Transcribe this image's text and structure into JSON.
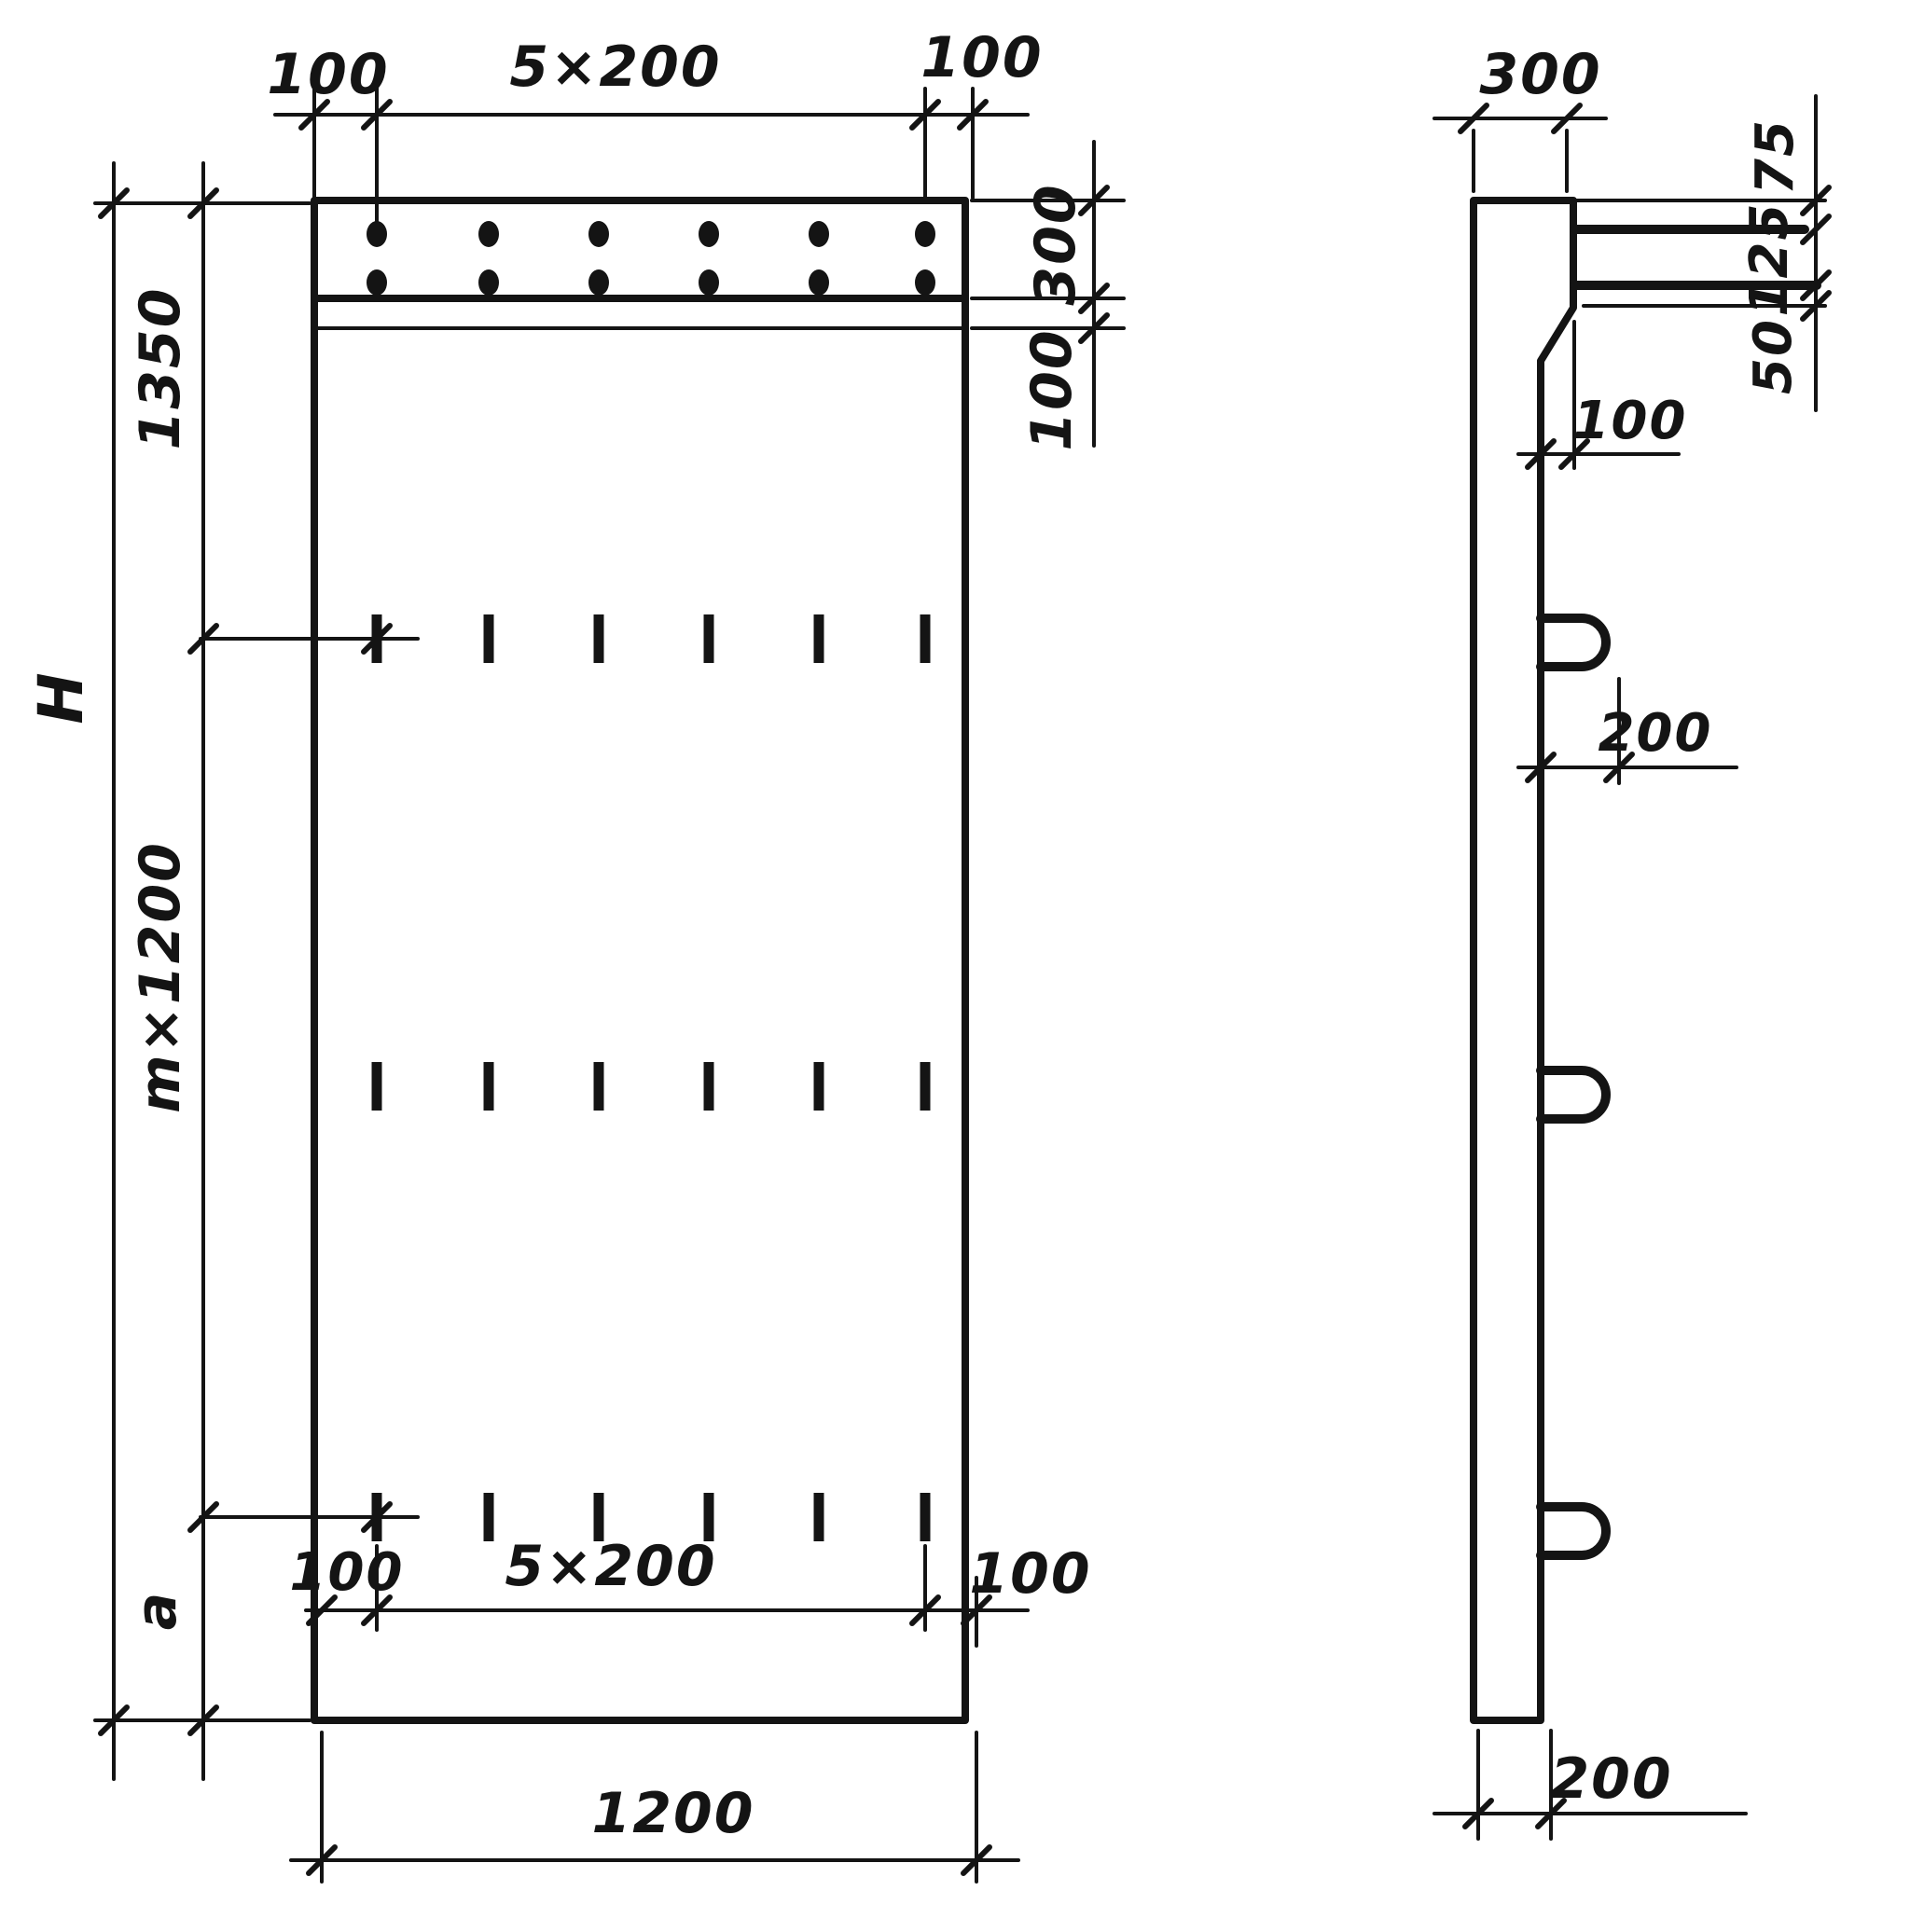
{
  "drawing": {
    "front_view": {
      "dim_top_left_margin": "100",
      "dim_top_spacing": "5×200",
      "dim_top_right_margin": "100",
      "dim_band_height": "300",
      "dim_band_gap": "100",
      "dim_top_to_first_row": "1350",
      "dim_overall_height": "H",
      "dim_module_height": "m×1200",
      "dim_bottom_offset": "a",
      "dim_bottom_left_margin": "100",
      "dim_bottom_spacing": "5×200",
      "dim_bottom_right_margin": "100",
      "dim_width": "1200"
    },
    "side_view": {
      "dim_top_thickness": "300",
      "dim_bar1_offset": "75",
      "dim_bar_spacing": "125",
      "dim_bar2_to_edge": "50",
      "dim_step": "100",
      "dim_loop_length": "200",
      "dim_bottom_thickness": "200"
    }
  }
}
